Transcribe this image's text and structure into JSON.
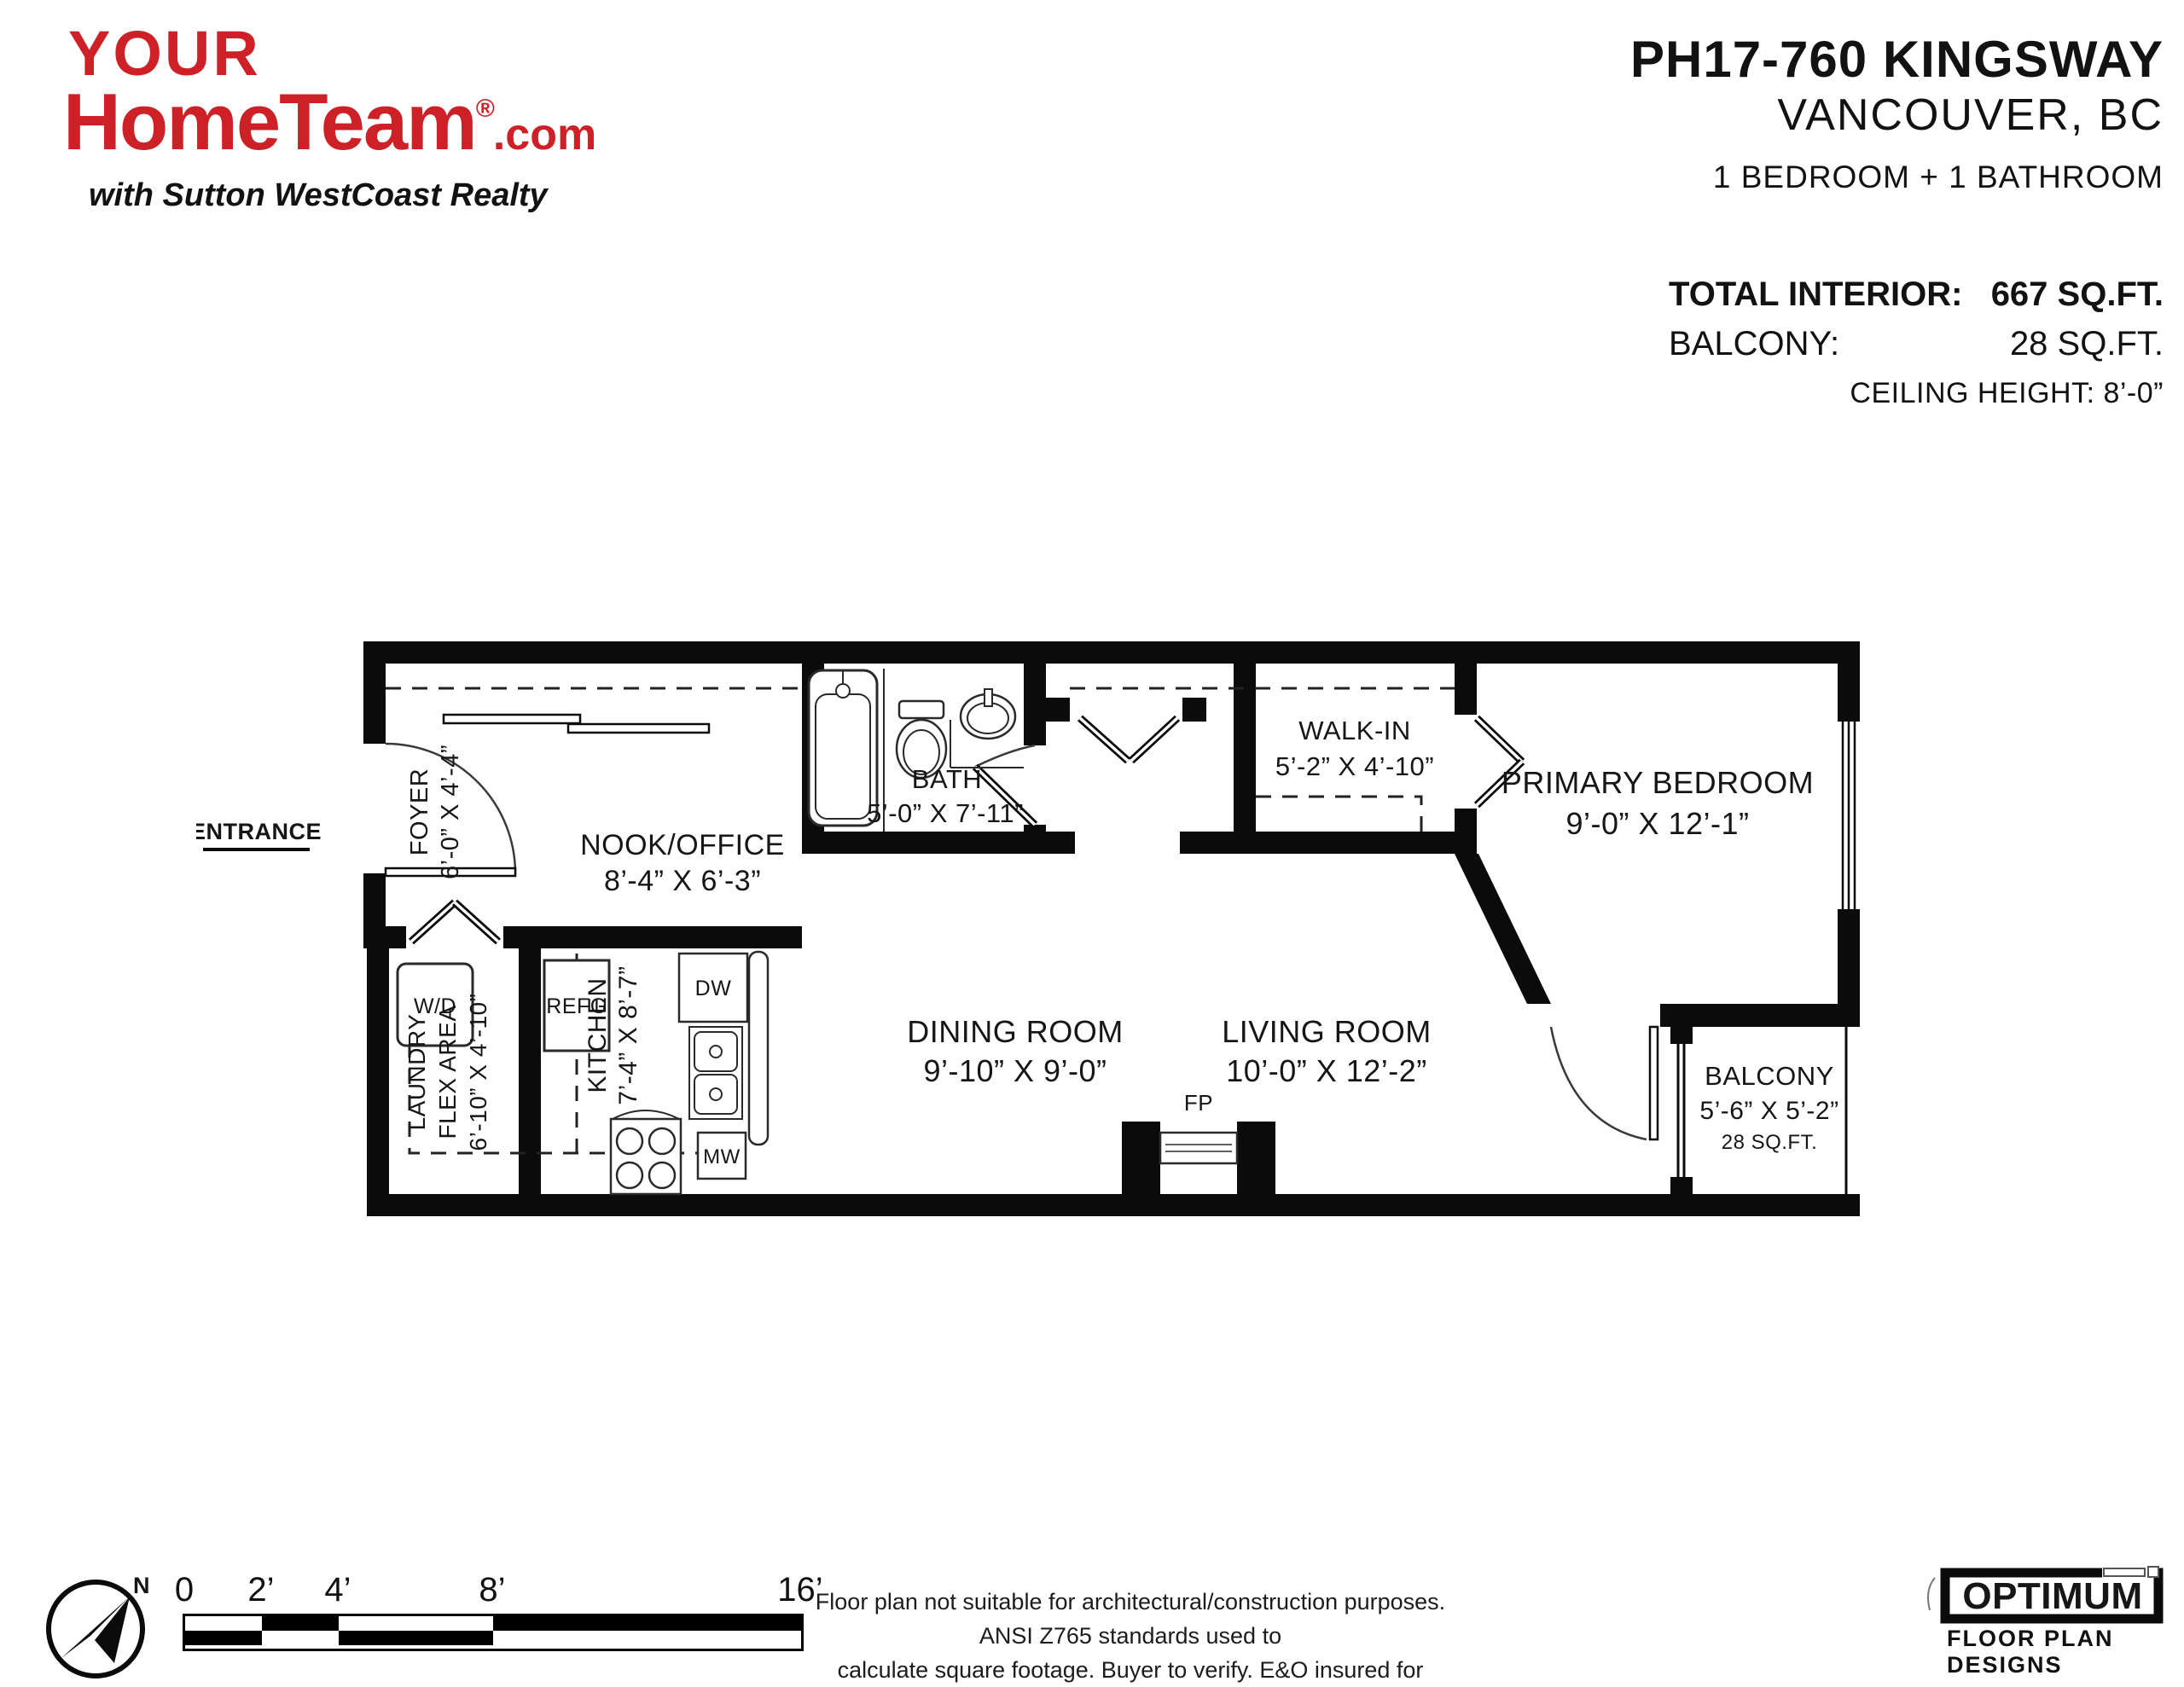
{
  "header": {
    "logo": {
      "line1": "YOUR",
      "line2": "HomeTeam",
      "reg": "®",
      "suffix": ".com",
      "tagline": "with Sutton WestCoast Realty",
      "brand_color": "#ce2127"
    },
    "title": "PH17-760 KINGSWAY",
    "city": "VANCOUVER, BC",
    "config": "1 BEDROOM + 1 BATHROOM",
    "stats": {
      "interior_label": "TOTAL INTERIOR:",
      "interior_value": "667 SQ.FT.",
      "balcony_label": "BALCONY:",
      "balcony_value": "28 SQ.FT.",
      "ceiling": "CEILING HEIGHT: 8’-0”"
    }
  },
  "plan": {
    "entrance": "ENTRANCE",
    "rooms": {
      "foyer": {
        "name": "FOYER",
        "dims": "6’-0” X 4’-4”"
      },
      "nook": {
        "name": "NOOK/OFFICE",
        "dims": "8’-4” X 6’-3”"
      },
      "bath": {
        "name": "BATH",
        "dims": "5’-0” X 7’-11”"
      },
      "walkin": {
        "name": "WALK-IN",
        "dims": "5’-2” X 4’-10”"
      },
      "bedroom": {
        "name": "PRIMARY BEDROOM",
        "dims": "9’-0” X 12’-1”"
      },
      "laundry": {
        "name1": "LAUNDRY",
        "name2": "FLEX AREA",
        "dims": "6’-10” X 4’-10”"
      },
      "kitchen": {
        "name": "KITCHEN",
        "dims": "7’-4” X 8’-7”"
      },
      "dining": {
        "name": "DINING ROOM",
        "dims": "9’-10” X 9’-0”"
      },
      "living": {
        "name": "LIVING ROOM",
        "dims": "10’-0” X 12’-2”"
      },
      "balcony": {
        "name": "BALCONY",
        "dims": "5’-6” X 5’-2”",
        "area": "28 SQ.FT."
      }
    },
    "fixtures": {
      "wd": "W/D",
      "refg": "REFG",
      "dw": "DW",
      "mw": "MW",
      "fp": "FP"
    }
  },
  "footer": {
    "compass_n": "N",
    "scale_ticks": [
      "0",
      "2’",
      "4’",
      "8’",
      "16’"
    ],
    "disclaimer_line1": "Floor plan not suitable for architectural/construction purposes. ANSI Z765 standards used to",
    "disclaimer_line2": "calculate square footage. Buyer to verify.  E&O insured for $1,000,000.",
    "brand": {
      "name": "OPTIMUM",
      "sub": "FLOOR PLAN DESIGNS"
    }
  }
}
